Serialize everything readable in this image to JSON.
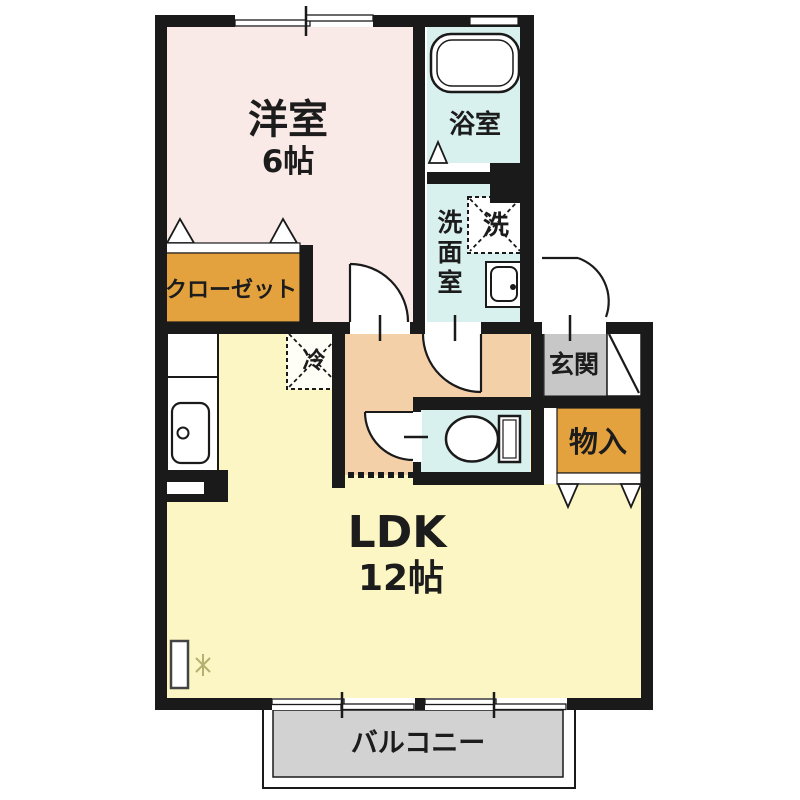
{
  "plan": {
    "rooms": {
      "western": {
        "name": "洋室",
        "size": "6帖"
      },
      "ldk": {
        "name": "LDK",
        "size": "12帖"
      },
      "bathroom": {
        "name": "浴室"
      },
      "washroom": {
        "chars": [
          "洗",
          "面",
          "室"
        ]
      },
      "closet": {
        "name": "クローゼット"
      },
      "entrance": {
        "name": "玄関"
      },
      "storage": {
        "name": "物入"
      },
      "balcony": {
        "name": "バルコニー"
      }
    },
    "symbols": {
      "washer": "洗",
      "fridge": "冷"
    },
    "colors": {
      "wall": "#1a1a1a",
      "western": "#f9e9e7",
      "water": "#d8f1ee",
      "hallway": "#f4d0a8",
      "ldk": "#fbf6c3",
      "closet": "#e3a23e",
      "entrance": "#c7c7c7",
      "balcony": "#d2d2d2",
      "white": "#ffffff"
    }
  }
}
